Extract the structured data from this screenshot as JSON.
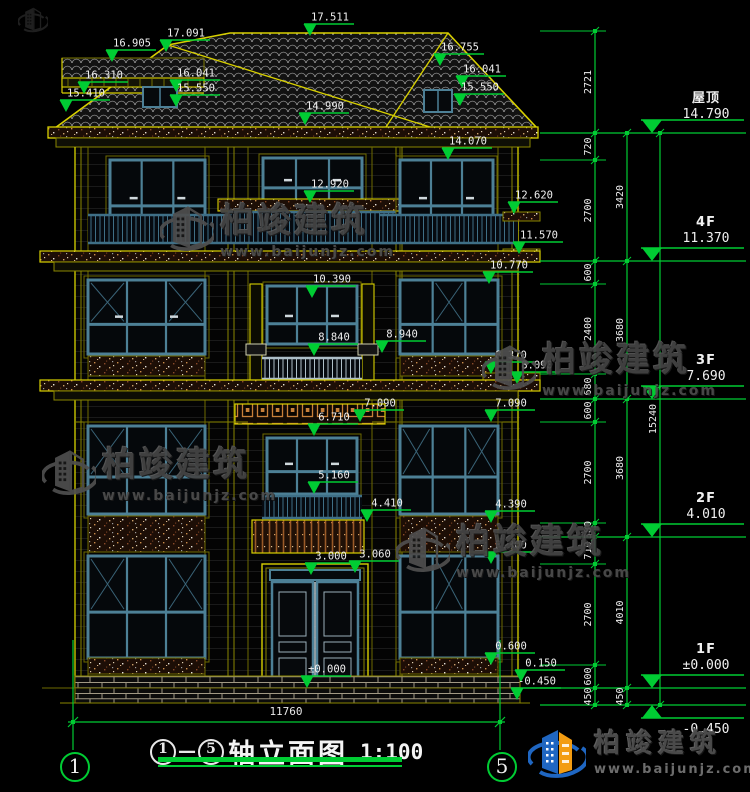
{
  "brand": {
    "name": "柏竣建筑",
    "site": "www.baijunjz.com"
  },
  "title_block": {
    "axis_from": "1",
    "dash": "—",
    "axis_to": "5",
    "name": "轴立面图",
    "scale": "1:100"
  },
  "axis_bubbles": {
    "left": "1",
    "right": "5"
  },
  "bottom_dim": "11760",
  "levels": [
    {
      "name": "屋顶",
      "value": "14.790",
      "y": 133,
      "below": false
    },
    {
      "name": "4F",
      "value": "11.370",
      "y": 261,
      "below": false
    },
    {
      "name": "3F",
      "value": "7.690",
      "y": 399,
      "below": false
    },
    {
      "name": "2F",
      "value": "4.010",
      "y": 537,
      "below": false
    },
    {
      "name": "1F",
      "value": "±0.000",
      "y": 688,
      "below": false
    },
    {
      "name": "",
      "value": "-0.450",
      "y": 705,
      "below": true
    }
  ],
  "elevation_markers": [
    {
      "label": "16.905",
      "x": 112,
      "y": 62
    },
    {
      "label": "17.091",
      "x": 166,
      "y": 52
    },
    {
      "label": "17.511",
      "x": 310,
      "y": 36
    },
    {
      "label": "16.310",
      "x": 84,
      "y": 94
    },
    {
      "label": "16.041",
      "x": 176,
      "y": 92
    },
    {
      "label": "15.550",
      "x": 176,
      "y": 107
    },
    {
      "label": "15.410",
      "x": 66,
      "y": 112
    },
    {
      "label": "16.755",
      "x": 440,
      "y": 66
    },
    {
      "label": "16.041",
      "x": 462,
      "y": 88
    },
    {
      "label": "15.550",
      "x": 460,
      "y": 106
    },
    {
      "label": "14.990",
      "x": 305,
      "y": 125
    },
    {
      "label": "14.070",
      "x": 448,
      "y": 160
    },
    {
      "label": "12.920",
      "x": 310,
      "y": 203
    },
    {
      "label": "12.620",
      "x": 514,
      "y": 214
    },
    {
      "label": "11.570",
      "x": 519,
      "y": 254
    },
    {
      "label": "10.770",
      "x": 489,
      "y": 284
    },
    {
      "label": "10.390",
      "x": 312,
      "y": 298
    },
    {
      "label": "8.840",
      "x": 314,
      "y": 356
    },
    {
      "label": "8.940",
      "x": 382,
      "y": 353
    },
    {
      "label": "8.370",
      "x": 491,
      "y": 374
    },
    {
      "label": "8.090",
      "x": 517,
      "y": 384
    },
    {
      "label": "7.090",
      "x": 360,
      "y": 422
    },
    {
      "label": "7.090",
      "x": 491,
      "y": 422
    },
    {
      "label": "6.710",
      "x": 314,
      "y": 436
    },
    {
      "label": "5.160",
      "x": 314,
      "y": 494
    },
    {
      "label": "4.410",
      "x": 367,
      "y": 522
    },
    {
      "label": "4.390",
      "x": 491,
      "y": 523
    },
    {
      "label": "3.300",
      "x": 491,
      "y": 564
    },
    {
      "label": "3.000",
      "x": 311,
      "y": 575
    },
    {
      "label": "3.060",
      "x": 355,
      "y": 573
    },
    {
      "label": "0.600",
      "x": 491,
      "y": 665
    },
    {
      "label": "0.150",
      "x": 521,
      "y": 682
    },
    {
      "label": "±0.000",
      "x": 307,
      "y": 688
    },
    {
      "label": "-0.450",
      "x": 517,
      "y": 700
    }
  ],
  "dim_chains": [
    {
      "x": 595,
      "segments": [
        {
          "v": "2721",
          "y1": 31,
          "y2": 133
        },
        {
          "v": "720",
          "y1": 133,
          "y2": 160
        },
        {
          "v": "2700",
          "y1": 160,
          "y2": 261
        },
        {
          "v": "600",
          "y1": 261,
          "y2": 284
        },
        {
          "v": "2400",
          "y1": 284,
          "y2": 374
        },
        {
          "v": "680",
          "y1": 374,
          "y2": 399
        },
        {
          "v": "600",
          "y1": 399,
          "y2": 422
        },
        {
          "v": "2700",
          "y1": 422,
          "y2": 523
        },
        {
          "v": "380",
          "y1": 523,
          "y2": 537
        },
        {
          "v": "710",
          "y1": 537,
          "y2": 564
        },
        {
          "v": "2700",
          "y1": 564,
          "y2": 665
        },
        {
          "v": "600",
          "y1": 665,
          "y2": 688
        },
        {
          "v": "450",
          "y1": 688,
          "y2": 705
        }
      ]
    },
    {
      "x": 627,
      "segments": [
        {
          "v": "3420",
          "y1": 133,
          "y2": 261
        },
        {
          "v": "3680",
          "y1": 261,
          "y2": 399
        },
        {
          "v": "3680",
          "y1": 399,
          "y2": 537
        },
        {
          "v": "4010",
          "y1": 537,
          "y2": 688
        },
        {
          "v": "450",
          "y1": 688,
          "y2": 705
        }
      ]
    },
    {
      "x": 660,
      "segments": [
        {
          "v": "15240",
          "y1": 133,
          "y2": 705
        }
      ]
    }
  ],
  "colors": {
    "green": "#00cc33",
    "yellow": "#d8d000",
    "teal": "#4d8096",
    "text": "#e8e8e8"
  }
}
